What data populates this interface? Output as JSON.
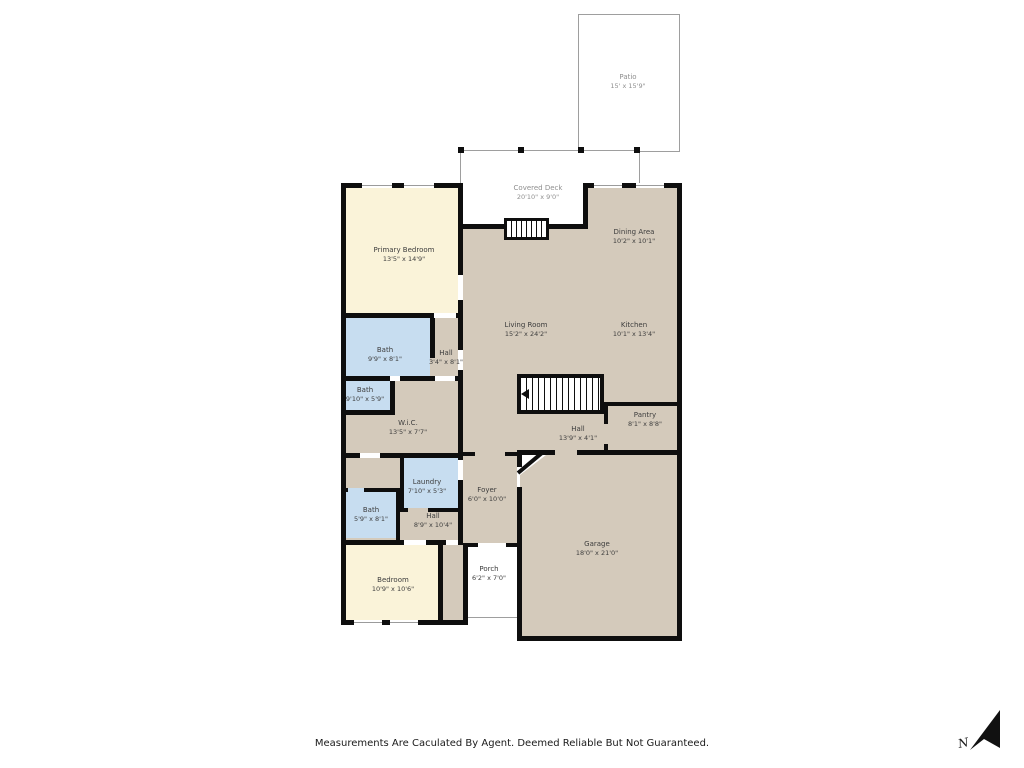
{
  "page": {
    "disclaimer": "Measurements Are Caculated By Agent. Deemed Reliable But Not Guaranteed.",
    "compass_label": "N"
  },
  "colors": {
    "wall": "#0e0e0e",
    "bedroom_fill": "#faf3d9",
    "bath_fill": "#c7ddf0",
    "living_fill": "#d4cabb",
    "outdoor_fill": "#ffffff",
    "outdoor_border": "#9e9e9e",
    "indoor_label_text": "#3d3d3d",
    "outdoor_label_text": "#8f8f8f"
  },
  "rooms": [
    {
      "id": "patio",
      "name": "Patio",
      "dims": "15' x 15'9\""
    },
    {
      "id": "covered-deck",
      "name": "Covered Deck",
      "dims": "20'10\" x 9'0\""
    },
    {
      "id": "primary-bedroom",
      "name": "Primary Bedroom",
      "dims": "13'5\" x 14'9\""
    },
    {
      "id": "dining-area",
      "name": "Dining Area",
      "dims": "10'2\" x 10'1\""
    },
    {
      "id": "living-room",
      "name": "Living Room",
      "dims": "15'2\" x 24'2\""
    },
    {
      "id": "kitchen",
      "name": "Kitchen",
      "dims": "10'1\" x 13'4\""
    },
    {
      "id": "bath-upper",
      "name": "Bath",
      "dims": "9'9\" x 8'1\""
    },
    {
      "id": "hall-upper",
      "name": "Hall",
      "dims": "3'4\" x 8'1\""
    },
    {
      "id": "bath-mid",
      "name": "Bath",
      "dims": "9'10\" x 5'9\""
    },
    {
      "id": "wic",
      "name": "W.i.C.",
      "dims": "13'5\" x 7'7\""
    },
    {
      "id": "pantry",
      "name": "Pantry",
      "dims": "8'1\" x 8'8\""
    },
    {
      "id": "hall-center",
      "name": "Hall",
      "dims": "13'9\" x 4'1\""
    },
    {
      "id": "laundry",
      "name": "Laundry",
      "dims": "7'10\" x 5'3\""
    },
    {
      "id": "foyer",
      "name": "Foyer",
      "dims": "6'0\" x 10'0\""
    },
    {
      "id": "bath-lower",
      "name": "Bath",
      "dims": "5'9\" x 8'1\""
    },
    {
      "id": "hall-lower",
      "name": "Hall",
      "dims": "8'9\" x 10'4\""
    },
    {
      "id": "bedroom",
      "name": "Bedroom",
      "dims": "10'9\" x 10'6\""
    },
    {
      "id": "porch",
      "name": "Porch",
      "dims": "6'2\" x 7'0\""
    },
    {
      "id": "garage",
      "name": "Garage",
      "dims": "18'0\" x 21'0\""
    }
  ]
}
